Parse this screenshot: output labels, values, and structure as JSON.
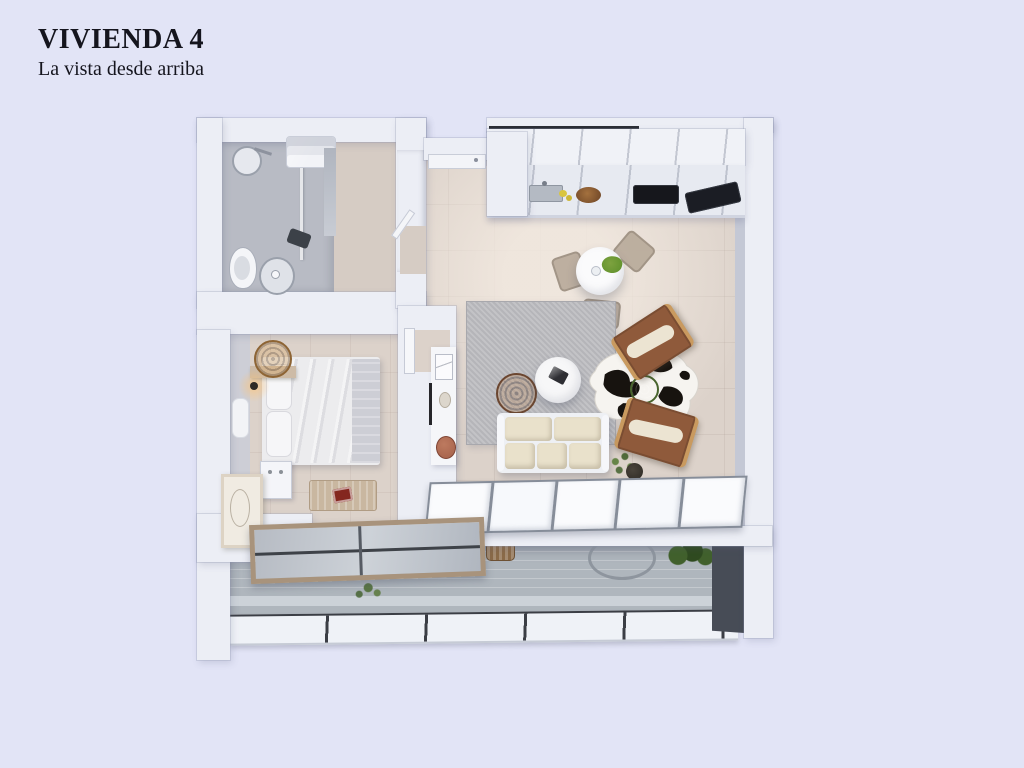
{
  "page": {
    "title": "VIVIENDA 4",
    "subtitle": "La vista desde arriba"
  },
  "colors": {
    "background": "#e2e4f6",
    "text": "#15151e",
    "wall": "#eceef5",
    "wall_shade": "#c4c8d5",
    "floor": "#dcd2ca",
    "floor_bath": "#d6ccc4",
    "shower_grey": "#b8bbc4",
    "rug": "#bcbcc0",
    "terrace_floor": "#afb6bd",
    "terrace_dark_wall": "#474c56",
    "railing": "#eff2f7",
    "sofa": "#e9e1cb",
    "armchair": "#8f5a3b",
    "armchair_wood": "#c99a5f",
    "pouf": "#96684a",
    "hat": "#bf8f55",
    "table_white": "#fbfbfc",
    "chair_tan": "#b9ab9b",
    "cooktop": "#16171c",
    "plant": "#7da23f",
    "plant_dark": "#41602c",
    "cowhide_black": "#17130f",
    "book_red": "#84271f",
    "terracotta": "#a4604a",
    "glass": "#b9bec6",
    "window_frame": "#a8937c",
    "bench": "#c9b7a0"
  }
}
